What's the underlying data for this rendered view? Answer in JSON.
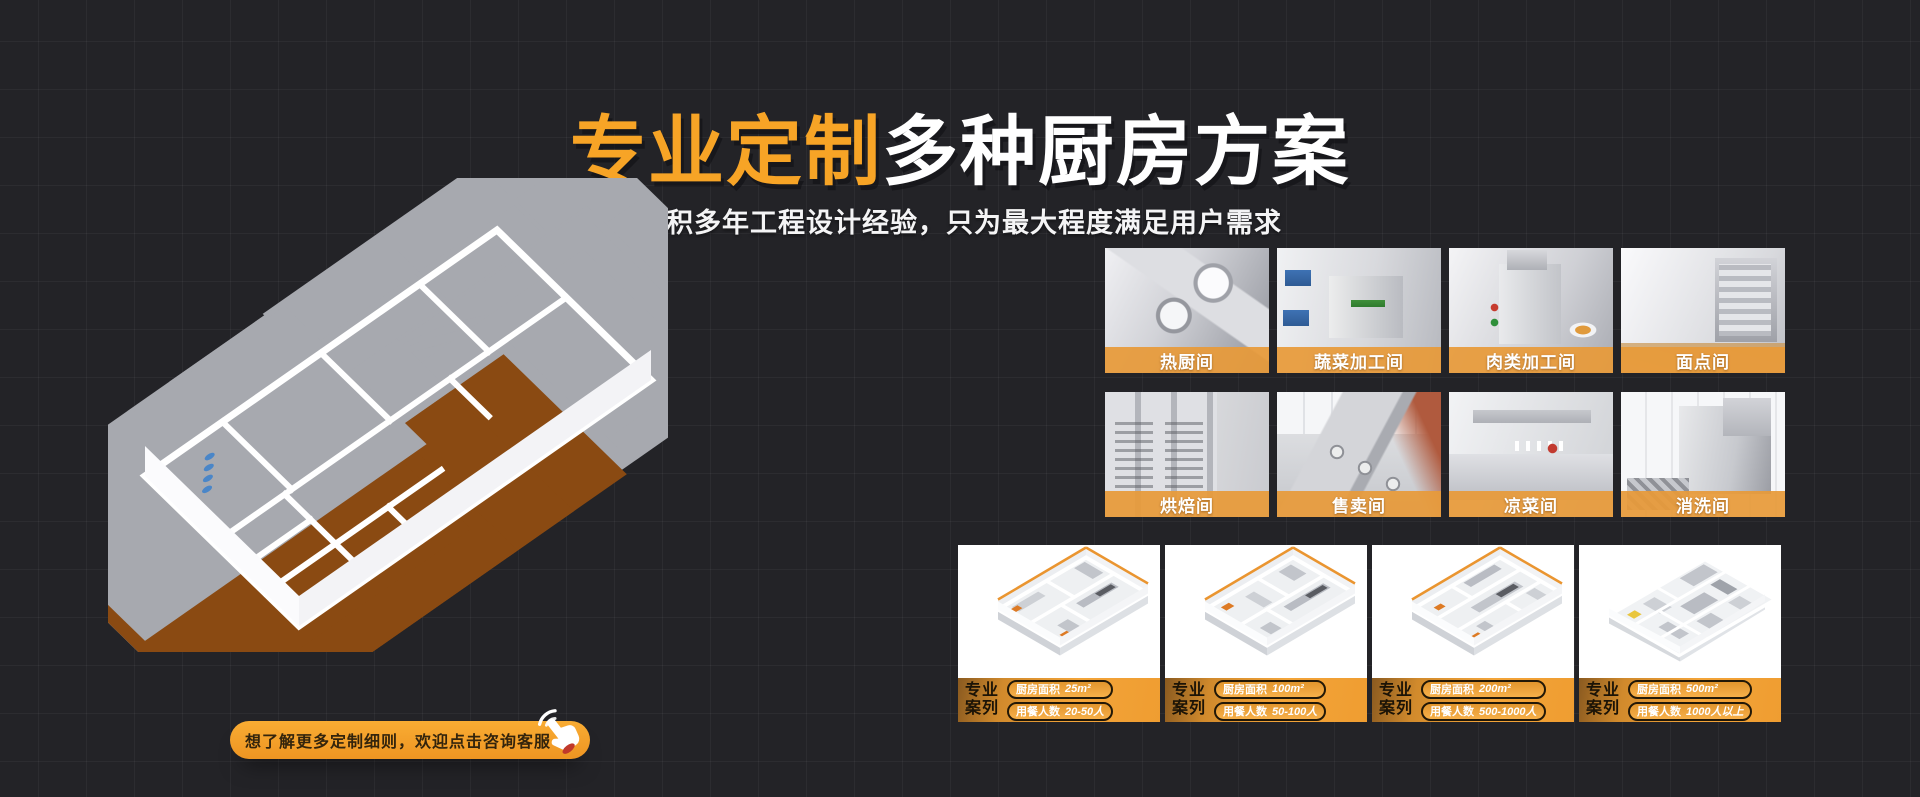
{
  "hero": {
    "title_highlight": "专业定制",
    "title_rest": "多种厨房方案",
    "subtitle": "累积多年工程设计经验，只为最大程度满足用户需求"
  },
  "gallery": {
    "items": [
      {
        "label": "热厨间"
      },
      {
        "label": "蔬菜加工间"
      },
      {
        "label": "肉类加工间"
      },
      {
        "label": "面点间"
      },
      {
        "label": "烘焙间"
      },
      {
        "label": "售卖间"
      },
      {
        "label": "凉菜间"
      },
      {
        "label": "消洗间"
      }
    ]
  },
  "cases": {
    "badge_line1": "专业",
    "badge_line2": "案列",
    "area_label": "厨房面积",
    "diners_label": "用餐人数",
    "items": [
      {
        "area": "25m²",
        "diners": "20-50人"
      },
      {
        "area": "100m²",
        "diners": "50-100人"
      },
      {
        "area": "200m²",
        "diners": "500-1000人"
      },
      {
        "area": "500m²",
        "diners": "1000人以上"
      }
    ]
  },
  "cta": {
    "label": "想了解更多定制细则，欢迎点击咨询客服",
    "icon": "hand-click-icon"
  },
  "colors": {
    "background": "#232327",
    "accent_orange": "#F7A426",
    "label_band": "#E79A39",
    "case_bar_dark": "#8A5A20",
    "case_bar_bright": "#F3A439"
  }
}
